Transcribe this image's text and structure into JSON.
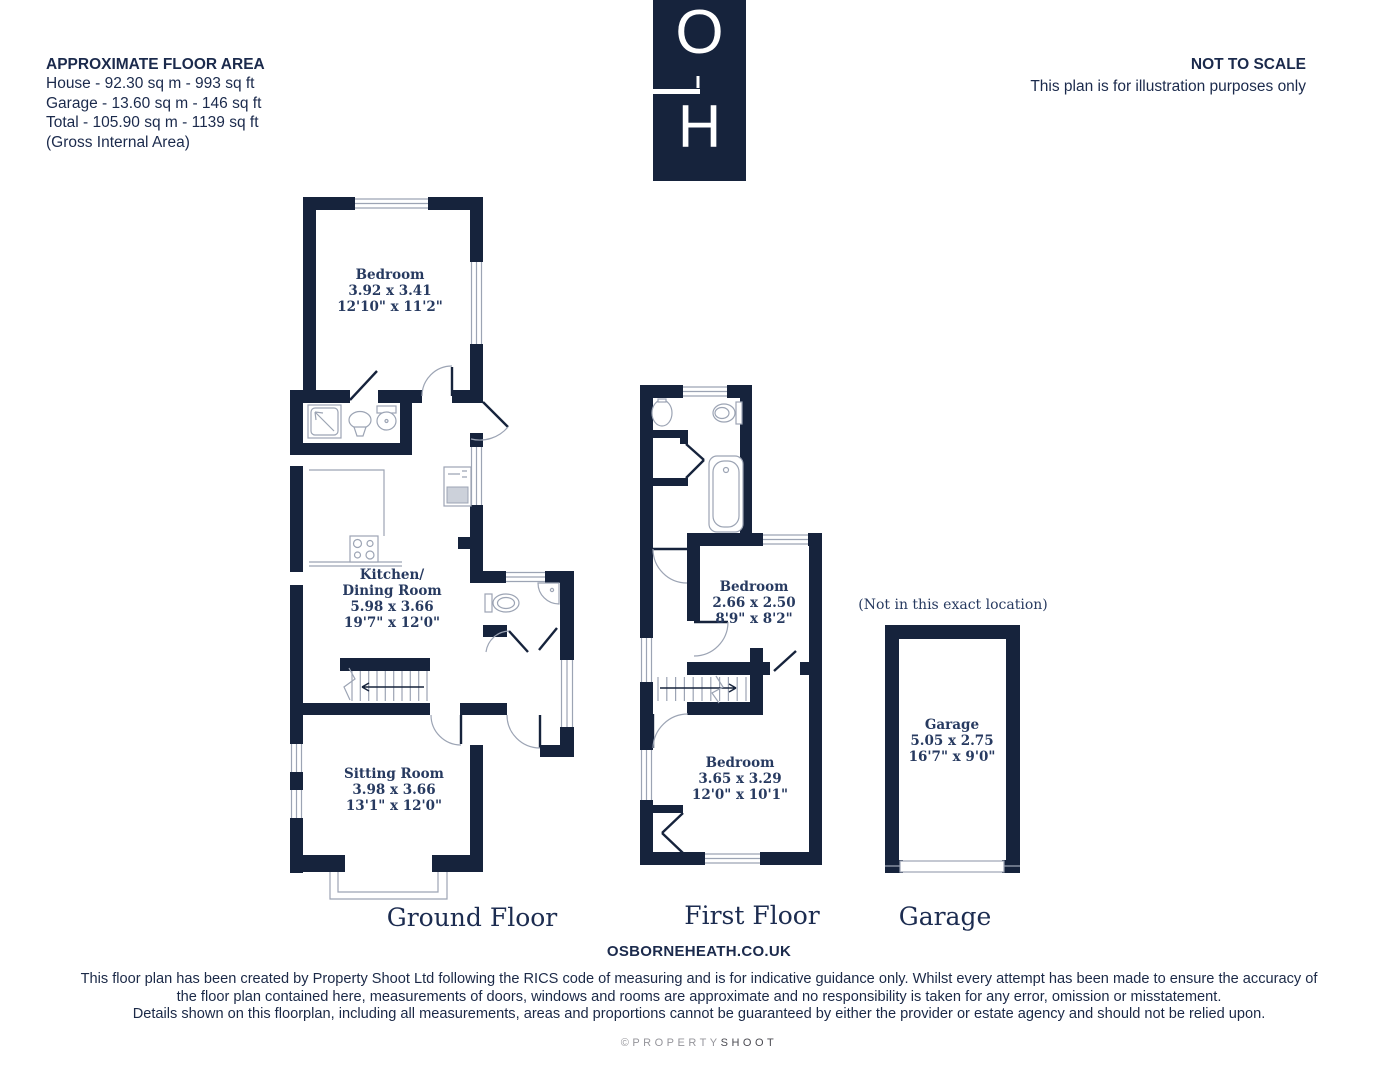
{
  "header": {
    "approx": {
      "title": "APPROXIMATE FLOOR AREA",
      "lines": [
        "House - 92.30 sq m - 993 sq ft",
        "Garage - 13.60 sq m - 146 sq ft",
        "Total - 105.90 sq m - 1139 sq ft",
        "(Gross Internal Area)"
      ]
    },
    "logo": {
      "letter_top": "O",
      "letter_bottom": "H"
    },
    "scale": {
      "title": "NOT TO SCALE",
      "subtitle": "This plan is for illustration purposes only"
    }
  },
  "plans": {
    "ground": {
      "title": "Ground Floor",
      "bedroom": {
        "name": "Bedroom",
        "metric": "3.92 x 3.41",
        "imperial": "12'10\" x 11'2\""
      },
      "kitchen": {
        "name_line1": "Kitchen/",
        "name_line2": "Dining Room",
        "metric": "5.98 x 3.66",
        "imperial": "19'7\" x 12'0\""
      },
      "sitting": {
        "name": "Sitting Room",
        "metric": "3.98 x 3.66",
        "imperial": "13'1\" x 12'0\""
      }
    },
    "first": {
      "title": "First Floor",
      "bedroom_rear": {
        "name": "Bedroom",
        "metric": "2.66 x 2.50",
        "imperial": "8'9\" x 8'2\""
      },
      "bedroom_front": {
        "name": "Bedroom",
        "metric": "3.65 x 3.29",
        "imperial": "12'0\" x 10'1\""
      }
    },
    "garage": {
      "title": "Garage",
      "note": "(Not in this exact location)",
      "room": {
        "name": "Garage",
        "metric": "5.05 x 2.75",
        "imperial": "16'7\" x 9'0\""
      }
    }
  },
  "footer": {
    "website": "OSBORNEHEATH.CO.UK",
    "disclaimer_line1": "This floor plan has been created by Property Shoot Ltd following the RICS code of measuring and is for indicative guidance only. Whilst every attempt has been made to ensure the accuracy of",
    "disclaimer_line2": "the floor plan contained here, measurements of doors, windows and rooms are approximate and no responsibility is taken for any error, omission or misstatement.",
    "disclaimer_line3": "Details shown on this floorplan, including all measurements, areas and proportions cannot be guaranteed by either the provider or estate agency and should not be relied upon.",
    "copyright_gray": "©PROPERTY",
    "copyright_dark": "SHOOT"
  },
  "colors": {
    "wall": "#16233C",
    "heading_text": "#1B2A4C",
    "label_text": "#273A60",
    "fixture_gray": "#9CA4B4"
  }
}
